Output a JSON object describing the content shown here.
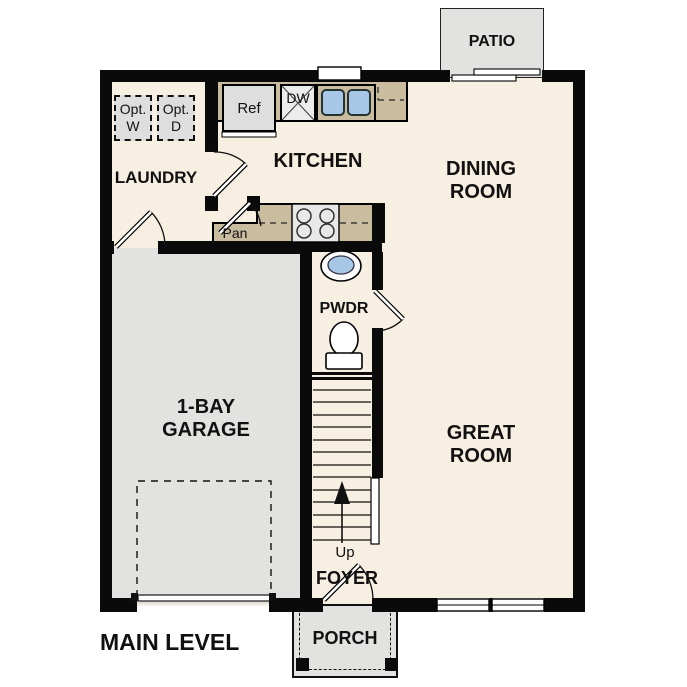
{
  "plan": {
    "level_label": "MAIN LEVEL",
    "rooms": {
      "patio": {
        "label": "PATIO"
      },
      "laundry": {
        "label": "LAUNDRY"
      },
      "kitchen": {
        "label": "KITCHEN"
      },
      "dining_room": {
        "line1": "DINING",
        "line2": "ROOM"
      },
      "great_room": {
        "line1": "GREAT",
        "line2": "ROOM"
      },
      "garage": {
        "line1": "1-BAY",
        "line2": "GARAGE"
      },
      "powder_room": {
        "label": "PWDR"
      },
      "pantry": {
        "label": "Pan"
      },
      "foyer": {
        "label": "FOYER"
      },
      "porch": {
        "label": "PORCH"
      }
    },
    "fixtures": {
      "refrigerator": {
        "label": "Ref"
      },
      "dishwasher": {
        "label": "DW"
      },
      "optional_washer": {
        "line1": "Opt.",
        "line2": "W"
      },
      "optional_dryer": {
        "line1": "Opt.",
        "line2": "D"
      },
      "stairs": {
        "direction_label": "Up"
      }
    },
    "colors": {
      "floor": "#f7efe1",
      "counter": "#c9bc9f",
      "concrete": "#e2e2e0",
      "fixture_gray": "#dedede",
      "sink_blue": "#a8c6e5",
      "wall": "#0a0a0a",
      "text": "#111111"
    }
  }
}
